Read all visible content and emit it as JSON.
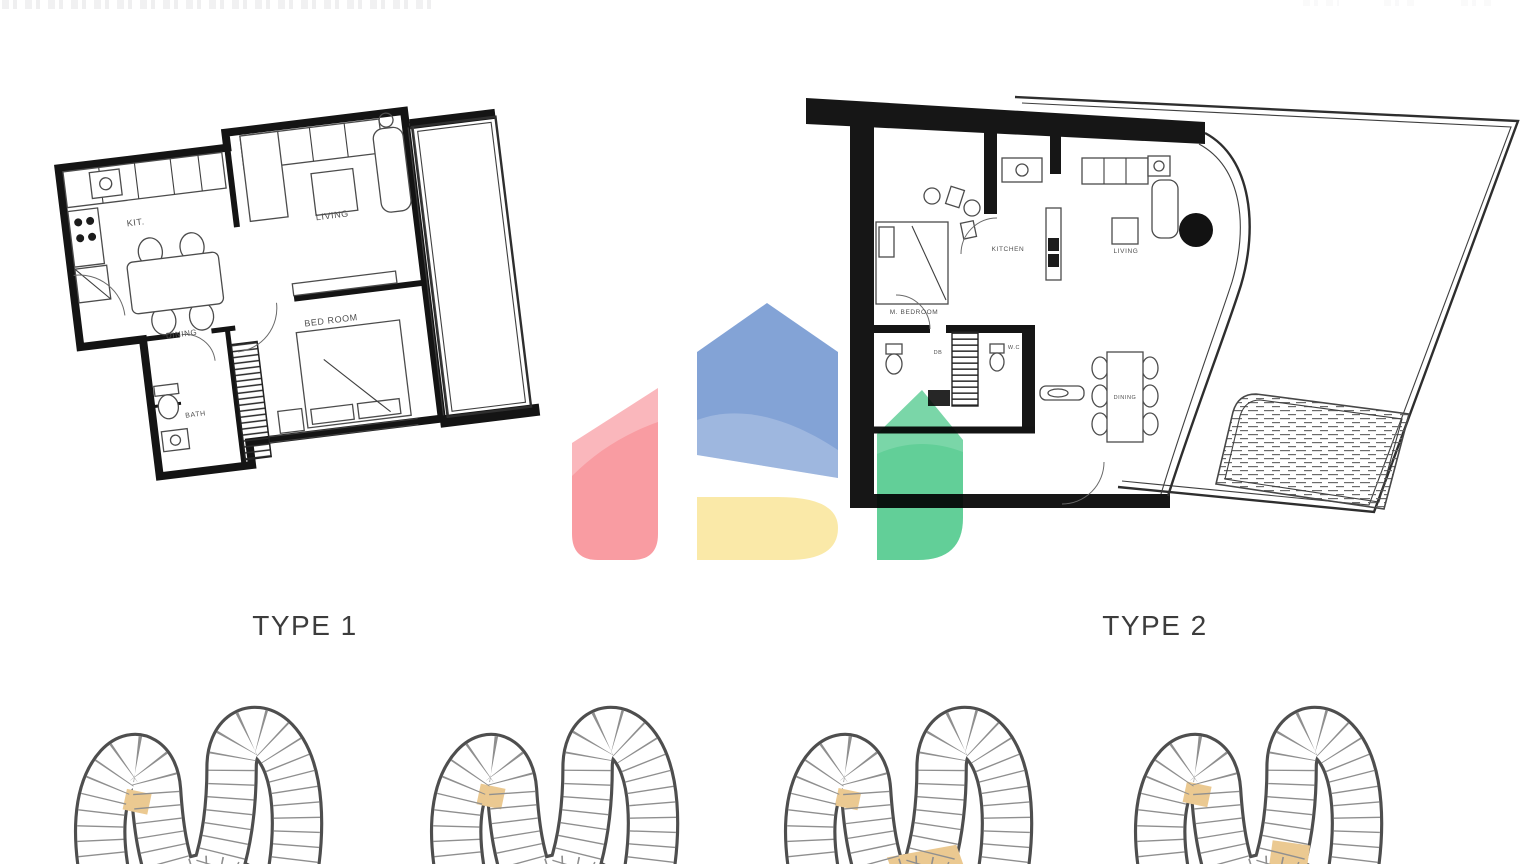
{
  "titles": {
    "type1": "TYPE 1",
    "type2": "TYPE 2"
  },
  "type1_rooms": {
    "kitchen": "KIT.",
    "dining": "DINING",
    "living": "LIVING",
    "bedroom": "BED ROOM",
    "bath": "BATH"
  },
  "type2_rooms": {
    "master_bedroom": "M. BEDROOM",
    "kitchen": "KITCHEN",
    "living": "LIVING",
    "dining": "DINING",
    "wc": "W.C",
    "db": "DB"
  },
  "watermark_colors": {
    "red": "#f9989e",
    "blue": "#7e9fd5",
    "yellow": "#fae9a5",
    "green": "#5bcd94"
  },
  "key_plan": {
    "count": 4,
    "highlight": "#ecc globally",
    "highlight_color": "#eac габ",
    "unit_highlight": "#ebc991",
    "outline_color": "#4e4e4e"
  }
}
